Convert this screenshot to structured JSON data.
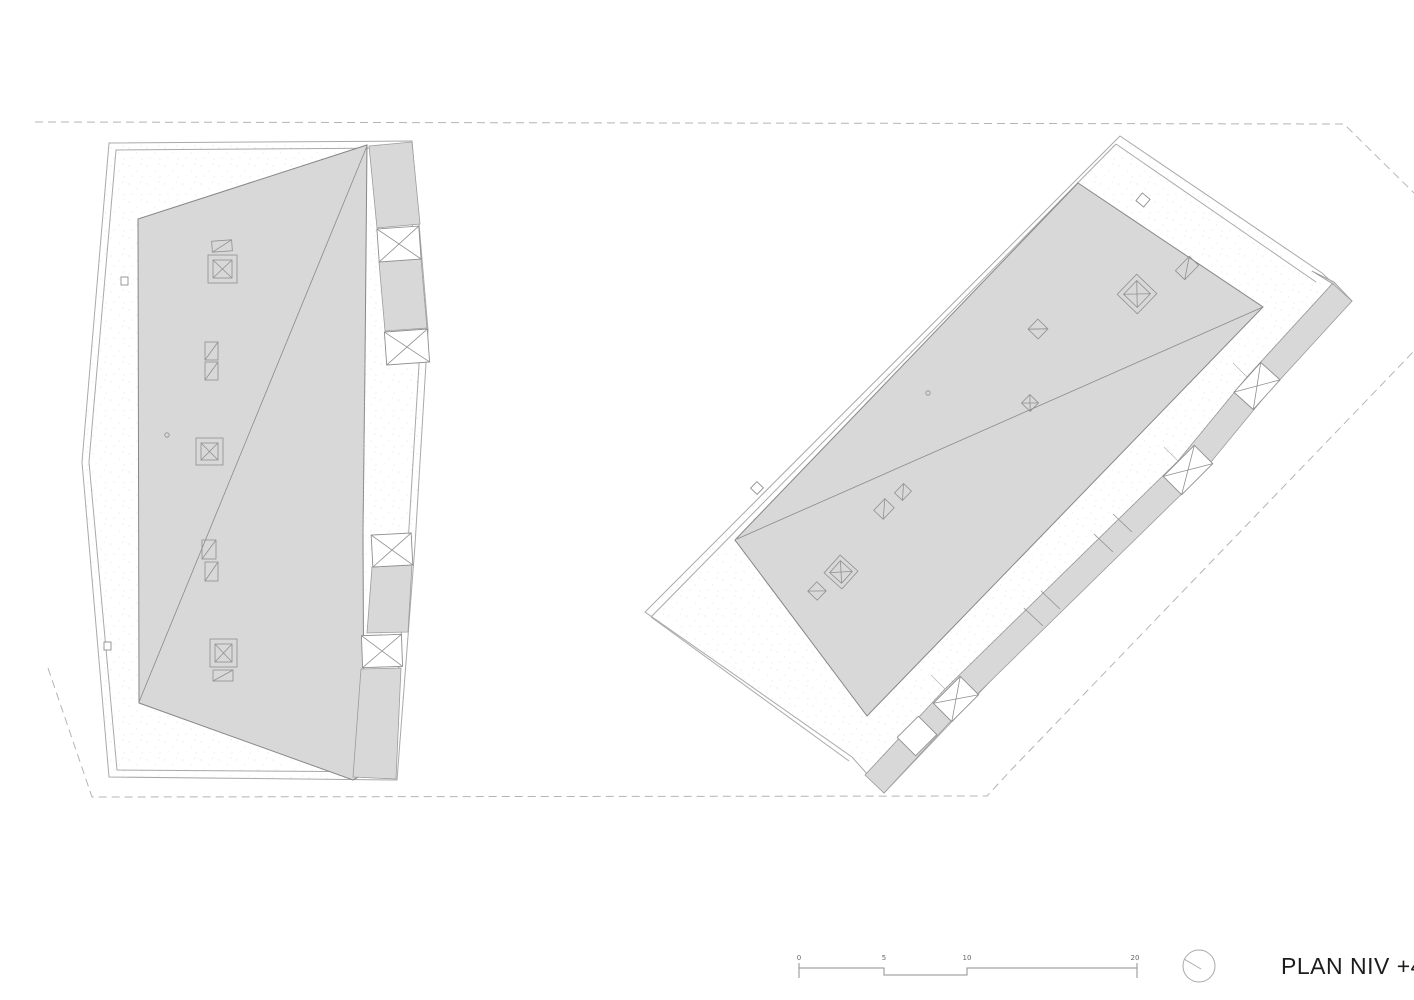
{
  "sheet": {
    "background_color": "#ffffff"
  },
  "title_block": {
    "label": "PLAN NIV +4"
  },
  "scale_bar": {
    "ticks": [
      "0",
      "5",
      "10",
      "20"
    ]
  },
  "north_indicator": {
    "icon": "north-circle-icon"
  },
  "palette": {
    "roof_fill": "#d8d8d8",
    "roof_outline": "#878787",
    "site_boundary": "#a9a9a9",
    "symbol_stroke": "#8f8f8f",
    "dashed_site_limit": "#b4b4b4",
    "title_text": "#1c1c1c",
    "scale_text": "#666666"
  },
  "legend_semantics": {
    "crossed_box": "stair-elevator-shaft",
    "double_square_cross": "elevator-core",
    "small_rect_diagonal": "roof-vent",
    "gray_polygon": "roof-surface",
    "dashed_line": "site-limit"
  }
}
